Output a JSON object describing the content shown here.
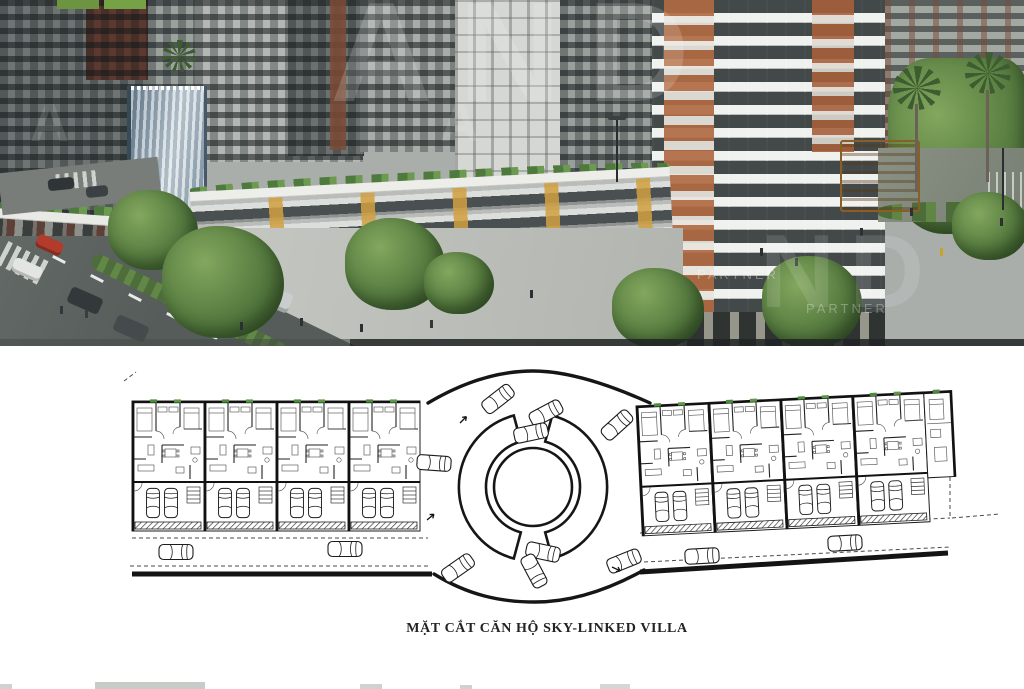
{
  "photo": {
    "watermarks": {
      "row1": "AND",
      "row2": "A A",
      "right_big": "ND",
      "fragment1": "PARTNER",
      "fragment2": "PARTNER"
    },
    "colors": {
      "billboard_green": "#6d9440",
      "waterfall_blue": "#8fa8b8",
      "accent_orange": "#b06a42",
      "accent_yellow": "#d1a040",
      "red_car": "#b23b2c"
    }
  },
  "plan": {
    "caption": "MẶT CẮT CĂN HỘ SKY-LINKED VILLA",
    "line_color": "#1e1e1e",
    "plant_color": "#4e8a3c",
    "wings": [
      {
        "name": "left-wing",
        "x": 132,
        "y": 401,
        "rot": 0,
        "units": 4,
        "unit_w": 72,
        "end_cap": false
      },
      {
        "name": "right-wing",
        "x": 636,
        "y": 406,
        "rot": -2.8,
        "units": 4,
        "unit_w": 72,
        "end_cap": true
      }
    ],
    "ring_cars": [
      [
        498,
        399,
        -38
      ],
      [
        546,
        413,
        -28
      ],
      [
        531,
        433,
        -12
      ],
      [
        617,
        425,
        -42
      ],
      [
        434,
        463,
        4
      ],
      [
        543,
        552,
        12
      ],
      [
        534,
        571,
        62
      ],
      [
        458,
        568,
        -35
      ],
      [
        624,
        561,
        -22
      ]
    ],
    "road_cars": [
      [
        176,
        552,
        0
      ],
      [
        345,
        549,
        0
      ],
      [
        702,
        556,
        -3
      ],
      [
        845,
        543,
        -3
      ]
    ],
    "ticks": [
      [
        460,
        423,
        -45
      ],
      [
        427,
        520,
        -40
      ],
      [
        612,
        567,
        25
      ]
    ]
  }
}
